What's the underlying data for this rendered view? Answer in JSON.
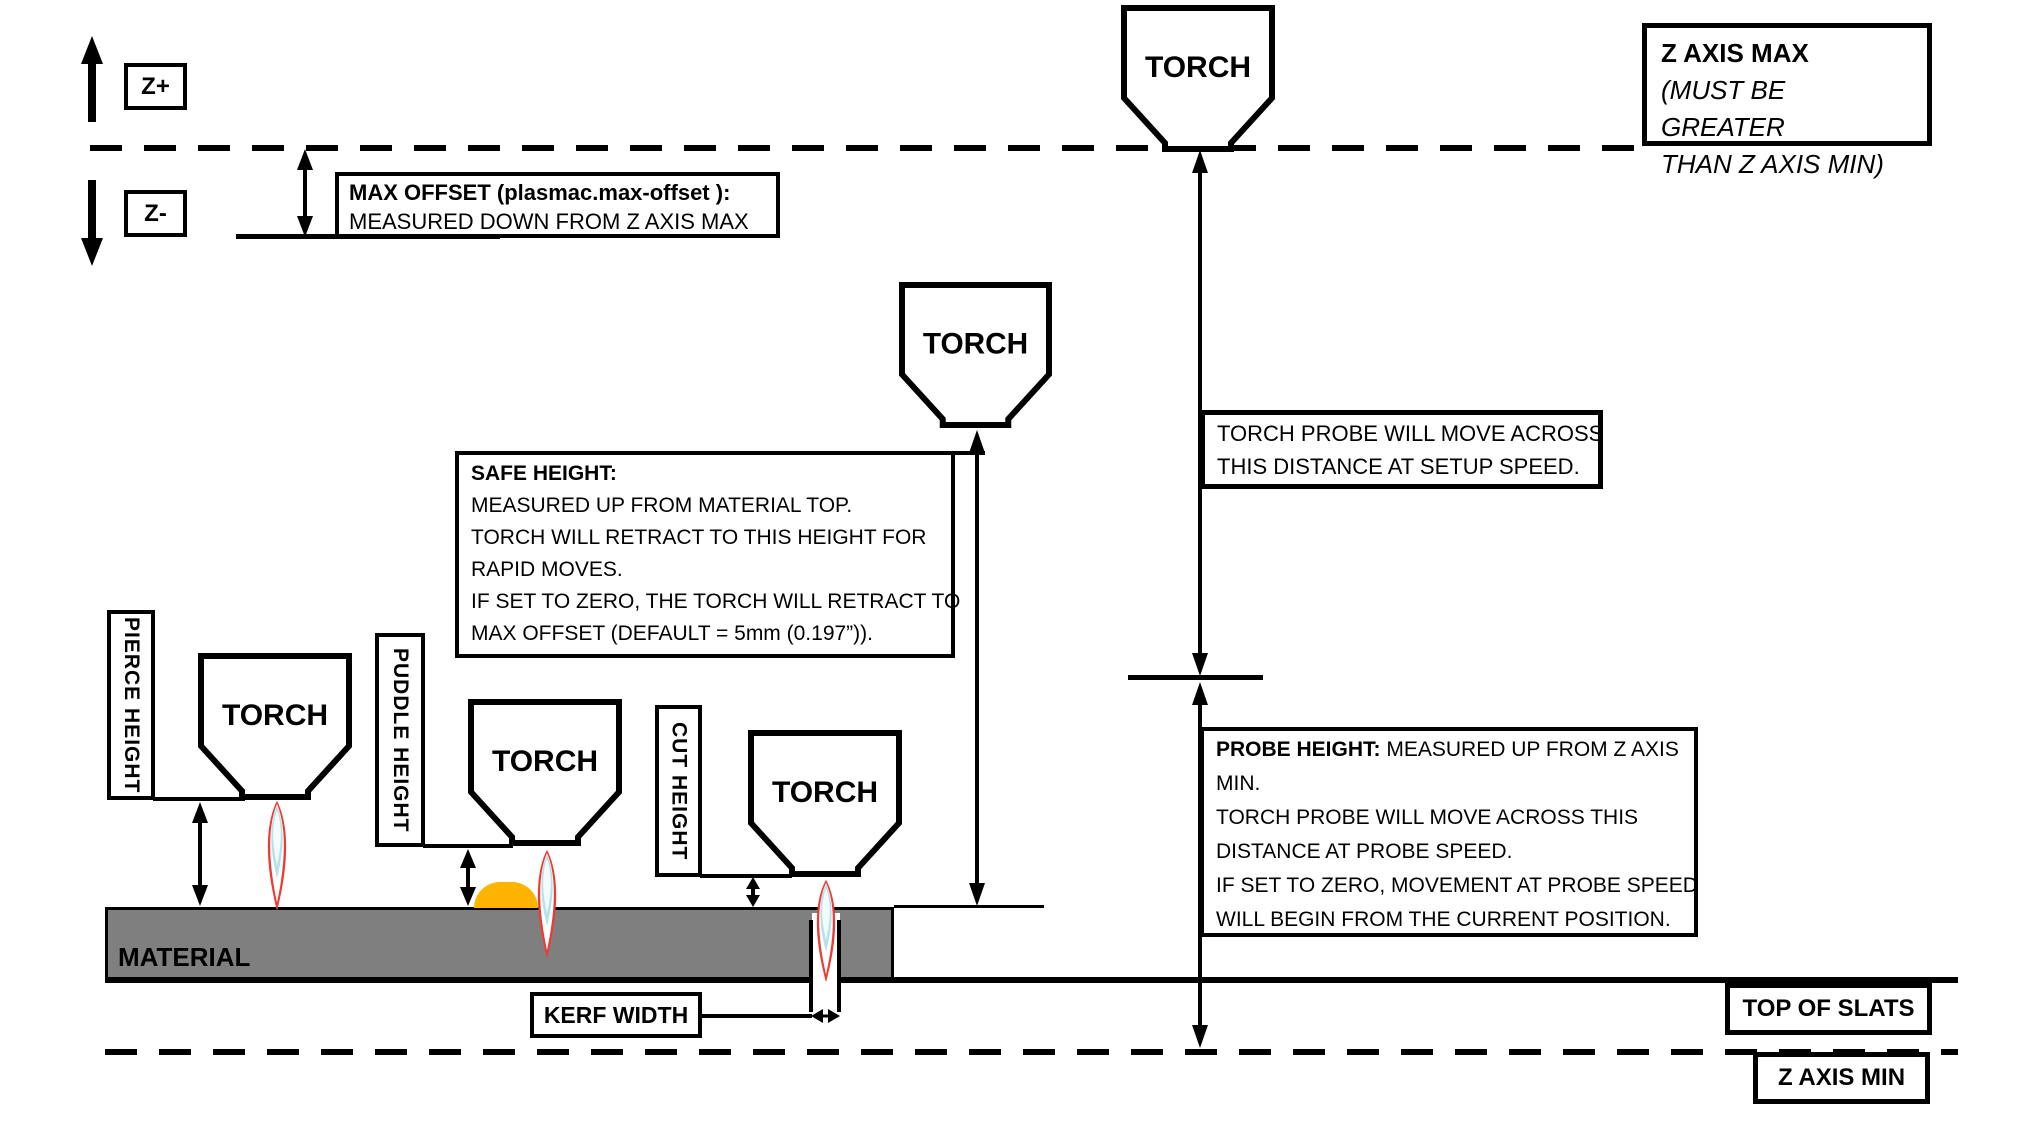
{
  "torch_label": "TORCH",
  "axis": {
    "z_plus": "Z+",
    "z_minus": "Z-"
  },
  "max_offset": {
    "line1": "MAX OFFSET (plasmac.max-offset ):",
    "line2": "MEASURED DOWN FROM Z AXIS MAX"
  },
  "z_axis_max": {
    "line1": "Z AXIS MAX",
    "line2": "(MUST BE GREATER",
    "line3": "THAN Z AXIS MIN)"
  },
  "torch_probe": {
    "line1": "TORCH PROBE WILL MOVE ACROSS",
    "line2": "THIS DISTANCE AT SETUP SPEED."
  },
  "safe_height": {
    "title": "SAFE HEIGHT:",
    "lines": [
      "MEASURED UP FROM MATERIAL TOP.",
      "TORCH WILL RETRACT TO THIS HEIGHT FOR",
      "RAPID MOVES.",
      "IF SET TO ZERO, THE TORCH WILL RETRACT TO",
      "MAX OFFSET (DEFAULT = 5mm (0.197”))."
    ]
  },
  "probe_height": {
    "title": "PROBE HEIGHT:",
    "title_rest": "MEASURED UP FROM Z AXIS",
    "lines": [
      "MIN.",
      "TORCH PROBE WILL MOVE ACROSS THIS",
      "DISTANCE AT PROBE SPEED.",
      "IF SET TO ZERO,  MOVEMENT AT PROBE SPEED",
      "WILL BEGIN FROM THE CURRENT POSITION."
    ]
  },
  "heights": {
    "pierce": "PIERCE HEIGHT",
    "puddle": "PUDDLE HEIGHT",
    "cut": "CUT HEIGHT"
  },
  "kerf": {
    "label": "KERF WIDTH"
  },
  "material_label": "MATERIAL",
  "top_of_slats": "TOP OF SLATS",
  "z_axis_min": "Z AXIS MIN",
  "colors": {
    "material_fill": "#7f7f7f",
    "puddle_fill": "#ffb400",
    "flame_outer": "#ee3a33",
    "flame_core": "#b5e3ea",
    "line": "#000000"
  }
}
